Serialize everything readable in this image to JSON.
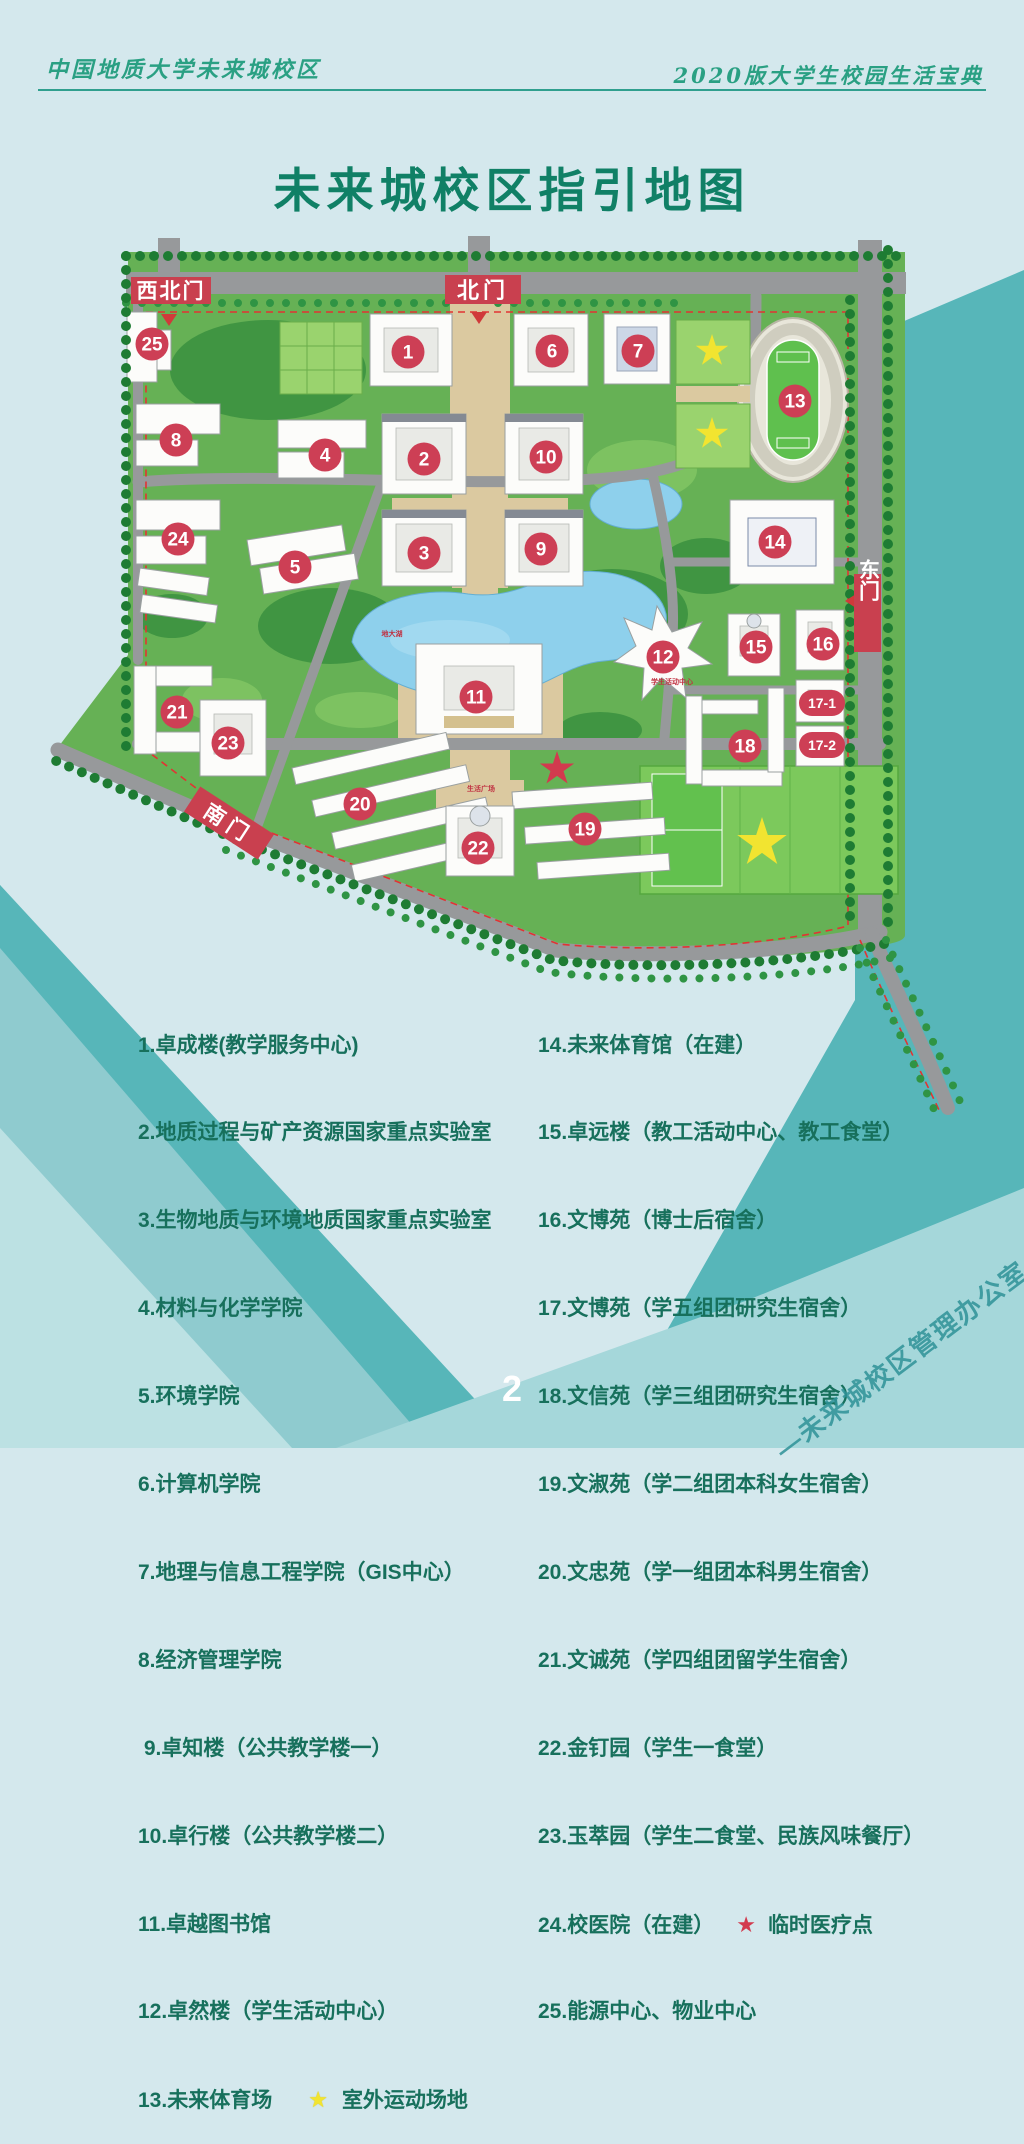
{
  "header": {
    "left": "中国地质大学未来城校区",
    "right": "2020版大学生校园生活宝典"
  },
  "title": "未来城校区指引地图",
  "map": {
    "gates": {
      "northwest": "西北门",
      "north": "北门",
      "east": "东门",
      "south": "南门"
    },
    "marker_labels": [
      "1",
      "2",
      "3",
      "4",
      "5",
      "6",
      "7",
      "8",
      "9",
      "10",
      "11",
      "12",
      "13",
      "14",
      "15",
      "16",
      "17-1",
      "17-2",
      "18",
      "19",
      "20",
      "21",
      "22",
      "23",
      "24",
      "25"
    ],
    "small_labels": {
      "lake": "地大湖",
      "student_center": "学生活动中心",
      "life_plaza": "生活广场"
    }
  },
  "legend": {
    "star": "★",
    "left": [
      "1.卓成楼(教学服务中心)",
      "2.地质过程与矿产资源国家重点实验室",
      "3.生物地质与环境地质国家重点实验室",
      "4.材料与化学学院",
      "5.环境学院",
      "6.计算机学院",
      "7.地理与信息工程学院（GIS中心）",
      "8.经济管理学院",
      " 9.卓知楼（公共教学楼一）",
      "10.卓行楼（公共教学楼二）",
      "11.卓越图书馆",
      "12.卓然楼（学生活动中心）",
      "13.未来体育场"
    ],
    "left_star_suffix": "室外运动场地",
    "right": [
      "14.未来体育馆（在建）",
      "15.卓远楼（教工活动中心、教工食堂）",
      "16.文博苑（博士后宿舍）",
      "17.文博苑（学五组团研究生宿舍）",
      "18.文信苑（学三组团研究生宿舍）",
      "19.文淑苑（学二组团本科女生宿舍）",
      "20.文忠苑（学一组团本科男生宿舍）",
      "21.文诚苑（学四组团留学生宿舍）",
      "22.金钉园（学生一食堂）",
      "23.玉萃园（学生二食堂、民族风味餐厅）",
      "24.校医院（在建）",
      "25.能源中心、物业中心"
    ],
    "right_star_suffix": "临时医疗点"
  },
  "footer": {
    "page_number": "2",
    "watermark": "—未来城校区管理办公室—"
  },
  "colors": {
    "accent_crimson": "#cd3f55",
    "legend_text_green": "#17705c",
    "title_green": "#108066",
    "teal_dark": "#57b6b9",
    "teal_medium": "#8fcbcf",
    "teal_light": "#a5d7da",
    "page_blue": "#d4e8ed",
    "map_green": "#66b155",
    "lake_blue": "#8ed0ec",
    "star_yellow": "#f2e430"
  }
}
